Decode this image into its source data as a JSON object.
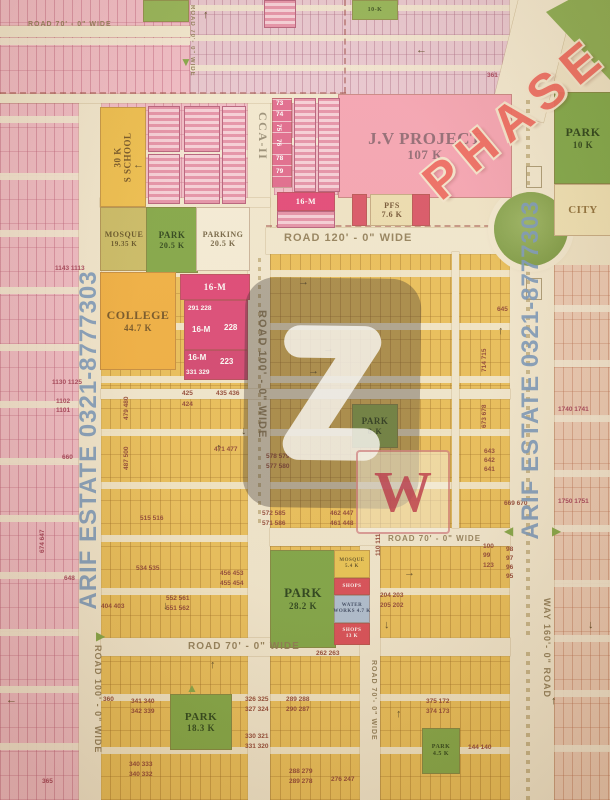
{
  "map": {
    "side_text_left": "ARIF ESTATE 0321-8777303",
    "side_text_right": "ARIF ESTATE 0321-8777303",
    "phase_label": "PHASE",
    "w_mark": "W",
    "landmarks": [
      {
        "name": "school",
        "lines": [
          "30 K",
          "S SCHOOL"
        ],
        "x": 100,
        "y": 107,
        "w": 44,
        "h": 98,
        "bg": "#eebc45",
        "fg": "#6b4a1a",
        "fs": 9,
        "fs2": 9,
        "rot": -90
      },
      {
        "name": "mosque-main",
        "lines": [
          "MOSQUE",
          "19.35 K"
        ],
        "x": 100,
        "y": 207,
        "w": 46,
        "h": 62,
        "bg": "#c8b95f",
        "fg": "#5a4a1c",
        "fs": 8,
        "fs2": 7
      },
      {
        "name": "park-20k",
        "lines": [
          "PARK",
          "20.5 K"
        ],
        "x": 146,
        "y": 207,
        "w": 50,
        "h": 64,
        "bg": "#7aa23d",
        "fg": "#1d380d",
        "fs": 9,
        "fs2": 8
      },
      {
        "name": "parking",
        "lines": [
          "PARKING",
          "20.5 K"
        ],
        "x": 196,
        "y": 207,
        "w": 52,
        "h": 62,
        "bg": "#f5edd8",
        "fg": "#6a5a3a",
        "fs": 8,
        "fs2": 8
      },
      {
        "name": "college",
        "lines": [
          "COLLEGE",
          "44.7 K"
        ],
        "x": 100,
        "y": 272,
        "w": 74,
        "h": 96,
        "bg": "#f1ac38",
        "fg": "#6b4a1a",
        "fs": 12,
        "fs2": 9
      },
      {
        "name": "jv-project",
        "lines": [
          "J.V PROJECT",
          "107 K"
        ],
        "x": 338,
        "y": 94,
        "w": 172,
        "h": 102,
        "bg": "#f59fb1",
        "fg": "#8a616e",
        "fs": 17,
        "fs2": 13
      },
      {
        "name": "pfs",
        "lines": [
          "PFS",
          "7.6 K"
        ],
        "x": 370,
        "y": 194,
        "w": 42,
        "h": 30,
        "bg": "#ecdcae",
        "fg": "#6b4a2a",
        "fs": 8,
        "fs2": 8
      },
      {
        "name": "park-8k",
        "lines": [
          "PARK",
          "8-K"
        ],
        "x": 352,
        "y": 404,
        "w": 44,
        "h": 42,
        "bg": "#86a944",
        "fg": "#1d380d",
        "fs": 9,
        "fs2": 8
      },
      {
        "name": "park-28k",
        "lines": [
          "PARK",
          "28.2 K"
        ],
        "x": 270,
        "y": 550,
        "w": 64,
        "h": 96,
        "bg": "#76a13c",
        "fg": "#17330c",
        "fs": 13,
        "fs2": 9
      },
      {
        "name": "mosque-small",
        "lines": [
          "MOSQUE",
          "5.4 K"
        ],
        "x": 334,
        "y": 550,
        "w": 34,
        "h": 26,
        "bg": "#e9c24b",
        "fg": "#5a4a1c",
        "fs": 5,
        "fs2": 5
      },
      {
        "name": "shops-1",
        "lines": [
          "SHOPS"
        ],
        "x": 334,
        "y": 578,
        "w": 34,
        "h": 15,
        "bg": "#d8414f",
        "fg": "#ffffff",
        "fs": 5
      },
      {
        "name": "water-works",
        "lines": [
          "WATER",
          "WORKS 4.7 K"
        ],
        "x": 334,
        "y": 595,
        "w": 34,
        "h": 26,
        "bg": "#a9bcd4",
        "fg": "#2a3a5a",
        "fs": 5,
        "fs2": 5
      },
      {
        "name": "shops-2",
        "lines": [
          "SHOPS",
          "13 K"
        ],
        "x": 334,
        "y": 623,
        "w": 34,
        "h": 20,
        "bg": "#d8414f",
        "fg": "#ffffff",
        "fs": 5,
        "fs2": 5
      },
      {
        "name": "park-18k",
        "lines": [
          "PARK",
          "18.3 K"
        ],
        "x": 170,
        "y": 694,
        "w": 60,
        "h": 54,
        "bg": "#79a43e",
        "fg": "#1c3a0e",
        "fs": 11,
        "fs2": 9
      },
      {
        "name": "park-small",
        "lines": [
          "PARK",
          "4.5 K"
        ],
        "x": 422,
        "y": 728,
        "w": 36,
        "h": 44,
        "bg": "#7ba440",
        "fg": "#1d380d",
        "fs": 6,
        "fs2": 6
      },
      {
        "name": "park-right",
        "lines": [
          "PARK",
          "10 K"
        ],
        "x": 554,
        "y": 92,
        "w": 56,
        "h": 90,
        "bg": "#78a441",
        "fg": "#1d380d",
        "fs": 12,
        "fs2": 9
      },
      {
        "name": "city-block",
        "lines": [
          "CITY"
        ],
        "x": 554,
        "y": 184,
        "w": 56,
        "h": 50,
        "bg": "#f0e2b4",
        "fg": "#8a6a34",
        "fs": 11
      },
      {
        "name": "green-top-1",
        "x": 143,
        "y": 0,
        "w": 44,
        "h": 20,
        "bg": "#8db04e"
      },
      {
        "name": "green-top-2",
        "lines": [
          "10-K"
        ],
        "x": 352,
        "y": 0,
        "w": 44,
        "h": 18,
        "bg": "#8db04e",
        "fg": "#2c4513",
        "fs": 6
      },
      {
        "name": "m16-strip",
        "lines": [
          "16-M"
        ],
        "x": 277,
        "y": 192,
        "w": 56,
        "h": 17,
        "bg": "#e23d72",
        "fg": "#ffffff",
        "fs": 8
      },
      {
        "name": "m16-strip-2",
        "x": 277,
        "y": 211,
        "w": 56,
        "h": 15,
        "cls": "striped"
      },
      {
        "name": "red-block-left",
        "x": 352,
        "y": 194,
        "w": 13,
        "h": 30,
        "bg": "#d84b60"
      },
      {
        "name": "red-block-right",
        "x": 412,
        "y": 194,
        "w": 16,
        "h": 30,
        "bg": "#d84b60"
      },
      {
        "name": "m16-a",
        "lines": [
          "16-M"
        ],
        "x": 180,
        "y": 274,
        "w": 68,
        "h": 24,
        "bg": "#dd3a70",
        "fg": "#ffffff",
        "fs": 9
      },
      {
        "name": "m16-b",
        "x": 184,
        "y": 300,
        "w": 62,
        "h": 48,
        "bg": "#db3e72"
      },
      {
        "name": "m16-c",
        "x": 184,
        "y": 350,
        "w": 62,
        "h": 28,
        "bg": "#d23a6c"
      },
      {
        "name": "col-73",
        "x": 272,
        "y": 98,
        "w": 18,
        "h": 88,
        "bg": "#df6189",
        "cls": "hstripes"
      },
      {
        "name": "strip-col-1",
        "x": 294,
        "y": 98,
        "w": 20,
        "h": 92,
        "cls": "striped"
      },
      {
        "name": "strip-col-2",
        "x": 318,
        "y": 98,
        "w": 20,
        "h": 92,
        "cls": "striped"
      },
      {
        "name": "plot-block-a",
        "x": 148,
        "y": 106,
        "w": 30,
        "h": 44,
        "cls": "striped"
      },
      {
        "name": "plot-block-b",
        "x": 148,
        "y": 154,
        "w": 30,
        "h": 48,
        "cls": "striped"
      },
      {
        "name": "plot-block-c",
        "x": 184,
        "y": 106,
        "w": 34,
        "h": 44,
        "cls": "striped"
      },
      {
        "name": "plot-block-d",
        "x": 184,
        "y": 154,
        "w": 34,
        "h": 48,
        "cls": "striped"
      },
      {
        "name": "plot-block-e",
        "x": 222,
        "y": 106,
        "w": 22,
        "h": 96,
        "cls": "striped"
      },
      {
        "name": "red-top-1",
        "x": 264,
        "y": 0,
        "w": 30,
        "h": 26,
        "cls": "striped"
      },
      {
        "name": "outline-square-1",
        "x": 526,
        "y": 166,
        "w": 14,
        "h": 20,
        "cls": "outline"
      },
      {
        "name": "outline-square-2",
        "x": 526,
        "y": 278,
        "w": 14,
        "h": 20,
        "cls": "outline"
      }
    ],
    "road_labels": [
      {
        "text": "ROAD 70' - 0\" WIDE",
        "x": 28,
        "y": 21,
        "size": 7
      },
      {
        "text": "ROAD 70'- 0\" WIDE",
        "x": 195,
        "y": 5,
        "size": 6,
        "rot": 90
      },
      {
        "text": "ROAD 120' - 0\" WIDE",
        "x": 284,
        "y": 232,
        "size": 11
      },
      {
        "text": "ROAD 100' - 0\" WIDE",
        "x": 268,
        "y": 310,
        "size": 11,
        "rot": 90
      },
      {
        "text": "ROAD 70' - 0\" WIDE",
        "x": 388,
        "y": 534,
        "size": 8
      },
      {
        "text": "ROAD 70' - 0\" WIDE",
        "x": 188,
        "y": 641,
        "size": 10
      },
      {
        "text": "ROAD 100' - 0\" WIDE",
        "x": 103,
        "y": 645,
        "size": 9,
        "rot": 90
      },
      {
        "text": "ROAD 70'- 0\" WIDE",
        "x": 377,
        "y": 660,
        "size": 7,
        "rot": 90
      },
      {
        "text": "WAY 160'- 0\" ROAD",
        "x": 552,
        "y": 598,
        "size": 9,
        "rot": 90
      },
      {
        "text": "CCA-II",
        "x": 270,
        "y": 112,
        "size": 12,
        "rot": 90,
        "serif": true
      }
    ],
    "plot_numbers": [
      {
        "t": "425",
        "x": 182,
        "y": 391
      },
      {
        "t": "424",
        "x": 182,
        "y": 402
      },
      {
        "t": "435 436",
        "x": 216,
        "y": 391
      },
      {
        "t": "471 477",
        "x": 214,
        "y": 447
      },
      {
        "t": "578 579",
        "x": 266,
        "y": 454
      },
      {
        "t": "577 580",
        "x": 266,
        "y": 464
      },
      {
        "t": "572 585",
        "x": 262,
        "y": 511
      },
      {
        "t": "571 586",
        "x": 262,
        "y": 521
      },
      {
        "t": "462 447",
        "x": 330,
        "y": 511
      },
      {
        "t": "461 448",
        "x": 330,
        "y": 521
      },
      {
        "t": "456 453",
        "x": 220,
        "y": 571
      },
      {
        "t": "455 454",
        "x": 220,
        "y": 581
      },
      {
        "t": "552 561",
        "x": 166,
        "y": 596
      },
      {
        "t": "551 562",
        "x": 166,
        "y": 606
      },
      {
        "t": "404 403",
        "x": 101,
        "y": 604
      },
      {
        "t": "515 516",
        "x": 140,
        "y": 516
      },
      {
        "t": "534 535",
        "x": 136,
        "y": 566
      },
      {
        "t": "487 500",
        "x": 124,
        "y": 470,
        "r": -90
      },
      {
        "t": "479 480",
        "x": 124,
        "y": 420,
        "r": -90
      },
      {
        "t": "660",
        "x": 62,
        "y": 455,
        "c": "p"
      },
      {
        "t": "648",
        "x": 64,
        "y": 576,
        "c": "p"
      },
      {
        "t": "1130 1125",
        "x": 52,
        "y": 380,
        "c": "p"
      },
      {
        "t": "1102",
        "x": 56,
        "y": 399,
        "c": "p"
      },
      {
        "t": "1101",
        "x": 56,
        "y": 408,
        "c": "p"
      },
      {
        "t": "1143 1113",
        "x": 55,
        "y": 266,
        "c": "p"
      },
      {
        "t": "365",
        "x": 42,
        "y": 779,
        "c": "p"
      },
      {
        "t": "674 647",
        "x": 40,
        "y": 553,
        "r": -90,
        "c": "p"
      },
      {
        "t": "341 340",
        "x": 131,
        "y": 699
      },
      {
        "t": "342 339",
        "x": 131,
        "y": 709
      },
      {
        "t": "340 333",
        "x": 129,
        "y": 762
      },
      {
        "t": "340 332",
        "x": 129,
        "y": 772
      },
      {
        "t": "360",
        "x": 103,
        "y": 697
      },
      {
        "t": "326 325",
        "x": 245,
        "y": 697
      },
      {
        "t": "327 324",
        "x": 245,
        "y": 707
      },
      {
        "t": "289 288",
        "x": 286,
        "y": 697
      },
      {
        "t": "290 287",
        "x": 286,
        "y": 707
      },
      {
        "t": "330 321",
        "x": 245,
        "y": 734
      },
      {
        "t": "331 320",
        "x": 245,
        "y": 744
      },
      {
        "t": "288 279",
        "x": 289,
        "y": 769
      },
      {
        "t": "289 278",
        "x": 289,
        "y": 779
      },
      {
        "t": "276 247",
        "x": 331,
        "y": 777
      },
      {
        "t": "375 172",
        "x": 426,
        "y": 699
      },
      {
        "t": "374 173",
        "x": 426,
        "y": 709
      },
      {
        "t": "144 140",
        "x": 468,
        "y": 745
      },
      {
        "t": "204 203",
        "x": 380,
        "y": 593
      },
      {
        "t": "205 202",
        "x": 380,
        "y": 603
      },
      {
        "t": "262 263",
        "x": 316,
        "y": 651
      },
      {
        "t": "110 111",
        "x": 376,
        "y": 556,
        "r": -90
      },
      {
        "t": "645",
        "x": 497,
        "y": 307
      },
      {
        "t": "643",
        "x": 484,
        "y": 449
      },
      {
        "t": "642",
        "x": 484,
        "y": 458
      },
      {
        "t": "641",
        "x": 484,
        "y": 467
      },
      {
        "t": "669 670",
        "x": 504,
        "y": 501
      },
      {
        "t": "98",
        "x": 506,
        "y": 547
      },
      {
        "t": "97",
        "x": 506,
        "y": 556
      },
      {
        "t": "96",
        "x": 506,
        "y": 565
      },
      {
        "t": "95",
        "x": 506,
        "y": 574
      },
      {
        "t": "100",
        "x": 483,
        "y": 544
      },
      {
        "t": "99",
        "x": 483,
        "y": 553
      },
      {
        "t": "123",
        "x": 483,
        "y": 563
      },
      {
        "t": "714 715",
        "x": 482,
        "y": 372,
        "r": -90
      },
      {
        "t": "673 678",
        "x": 482,
        "y": 428,
        "r": -90
      },
      {
        "t": "361",
        "x": 487,
        "y": 73,
        "c": "p"
      },
      {
        "t": "1740 1741",
        "x": 558,
        "y": 407,
        "c": "p"
      },
      {
        "t": "1750 1751",
        "x": 558,
        "y": 499,
        "c": "p"
      },
      {
        "t": "73",
        "x": 276,
        "y": 101,
        "c": "w"
      },
      {
        "t": "74",
        "x": 276,
        "y": 112,
        "c": "w"
      },
      {
        "t": "75",
        "x": 281,
        "y": 124,
        "c": "w",
        "r": 90
      },
      {
        "t": "76",
        "x": 281,
        "y": 139,
        "c": "w",
        "r": 90
      },
      {
        "t": "78",
        "x": 276,
        "y": 156,
        "c": "w"
      },
      {
        "t": "79",
        "x": 276,
        "y": 169,
        "c": "w"
      },
      {
        "t": "291 228",
        "x": 188,
        "y": 306,
        "c": "w"
      },
      {
        "t": "16-M",
        "x": 192,
        "y": 326,
        "c": "w",
        "fs": 8
      },
      {
        "t": "228",
        "x": 224,
        "y": 324,
        "c": "w",
        "fs": 8
      },
      {
        "t": "16-M",
        "x": 188,
        "y": 354,
        "c": "w",
        "fs": 8
      },
      {
        "t": "223",
        "x": 220,
        "y": 358,
        "c": "w",
        "fs": 8
      },
      {
        "t": "331 329",
        "x": 186,
        "y": 370,
        "c": "w"
      }
    ],
    "arrows": [
      {
        "g": "←",
        "x": 133,
        "y": 160
      },
      {
        "g": "←",
        "x": 416,
        "y": 45
      },
      {
        "g": "↑",
        "x": 203,
        "y": 10
      },
      {
        "g": "→",
        "x": 298,
        "y": 277
      },
      {
        "g": "→",
        "x": 308,
        "y": 366
      },
      {
        "g": "→",
        "x": 323,
        "y": 344
      },
      {
        "g": "↓",
        "x": 163,
        "y": 601
      },
      {
        "g": "↑",
        "x": 216,
        "y": 443
      },
      {
        "g": "↓",
        "x": 241,
        "y": 426
      },
      {
        "g": "↑",
        "x": 396,
        "y": 709
      },
      {
        "g": "↓",
        "x": 384,
        "y": 620
      },
      {
        "g": "→",
        "x": 404,
        "y": 568
      },
      {
        "g": "↑",
        "x": 498,
        "y": 326
      },
      {
        "g": "↓",
        "x": 588,
        "y": 620
      },
      {
        "g": "↑",
        "x": 551,
        "y": 696
      },
      {
        "g": "←",
        "x": 6,
        "y": 695
      },
      {
        "g": "↑",
        "x": 210,
        "y": 660
      }
    ],
    "triangles": [
      {
        "g": "▼",
        "x": 180,
        "y": 56
      },
      {
        "g": "▶",
        "x": 96,
        "y": 630
      },
      {
        "g": "◀",
        "x": 504,
        "y": 525
      },
      {
        "g": "▶",
        "x": 552,
        "y": 525
      },
      {
        "g": "▲",
        "x": 186,
        "y": 682
      }
    ]
  }
}
